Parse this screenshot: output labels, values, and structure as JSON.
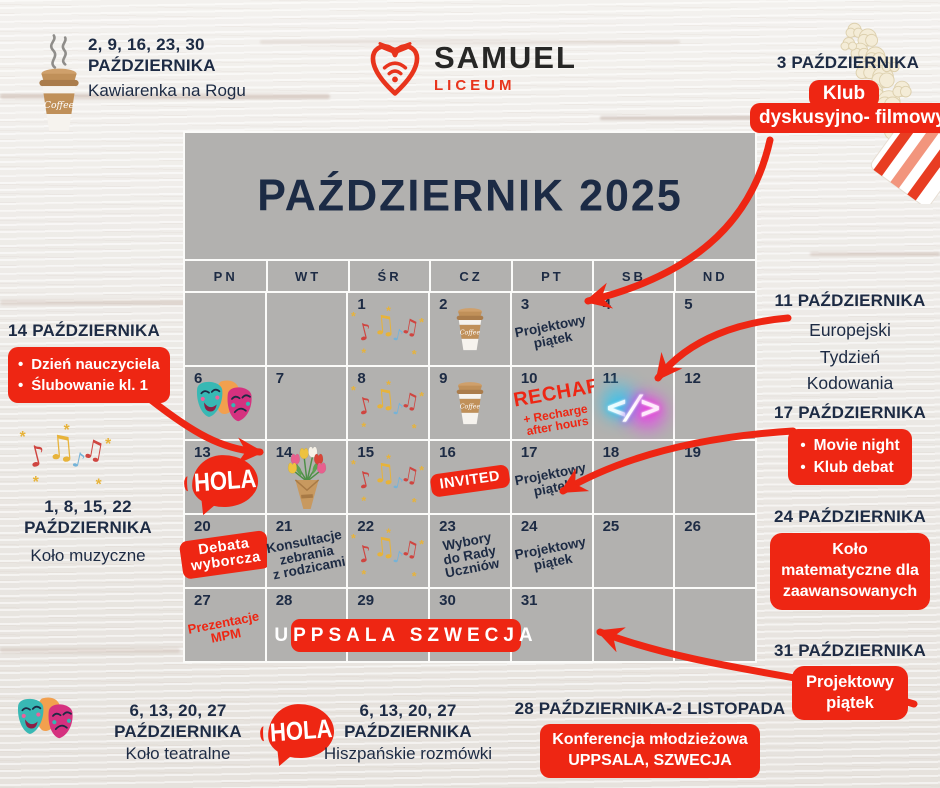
{
  "logo": {
    "name": "SAMUEL",
    "subtitle": "LICEUM"
  },
  "annotations": {
    "coffee": {
      "icon": "coffee-cup-icon",
      "dates": "2, 9, 16, 23, 30",
      "month": "PAŹDZIERNIKA",
      "label": "Kawiarenka na Rogu"
    },
    "film_club": {
      "icon": "popcorn-icon",
      "date": "3 PAŹDZIERNIKA",
      "badge": [
        "Klub",
        "dyskusyjno- filmowy"
      ]
    },
    "teachers_day": {
      "date": "14 PAŹDZIERNIKA",
      "badge": [
        "Dzień nauczyciela",
        "Ślubowanie kl. 1"
      ]
    },
    "music_club": {
      "icon": "music-notes-icon",
      "dates": "1, 8, 15, 22",
      "month": "PAŹDZIERNIKA",
      "label": "Koło muzyczne"
    },
    "coding_week": {
      "date": "11 PAŹDZIERNIKA",
      "lines": [
        "Europejski",
        "Tydzień",
        "Kodowania"
      ]
    },
    "movie_night": {
      "date": "17 PAŹDZIERNIKA",
      "badge": [
        "Movie night",
        "Klub debat"
      ]
    },
    "math_club": {
      "date": "24 PAŹDZIERNIKA",
      "badge": [
        "Koło",
        "matematyczne dla",
        "zaawansowanych"
      ]
    },
    "project_friday_31": {
      "date": "31 PAŹDZIERNIKA",
      "badge": [
        "Projektowy",
        "piątek"
      ]
    },
    "theatre_club": {
      "icon": "theater-masks-icon",
      "dates": "6, 13, 20, 27",
      "month": "PAŹDZIERNIKA",
      "label": "Koło teatralne"
    },
    "spanish_talks": {
      "icon": "hola-speech-bubble-icon",
      "dates": "6, 13, 20, 27",
      "month": "PAŹDZIERNIKA",
      "label": "Hiszpańskie rozmówki"
    },
    "conference": {
      "date": "28 PAŹDZIERNIKA-2 LISTOPADA",
      "badge": [
        "Konferencja młodzieżowa",
        "UPPSALA, SZWECJA"
      ]
    }
  },
  "calendar": {
    "title": "PAŹDZIERNIK 2025",
    "day_headers": [
      "PN",
      "WT",
      "ŚR",
      "CZ",
      "PT",
      "SB",
      "ND"
    ],
    "uppsala_badge": "UPPSALA SZWECJA",
    "cells": [
      {},
      {},
      {
        "day": "1",
        "icon": "music-notes-icon"
      },
      {
        "day": "2",
        "icon": "coffee-cup-icon"
      },
      {
        "day": "3",
        "note": [
          "Projektowy",
          "piątek"
        ],
        "style": "navy"
      },
      {
        "day": "4"
      },
      {
        "day": "5"
      },
      {
        "day": "6",
        "icon": "theater-masks-icon"
      },
      {
        "day": "7"
      },
      {
        "day": "8",
        "icon": "music-notes-icon"
      },
      {
        "day": "9",
        "icon": "coffee-cup-icon"
      },
      {
        "day": "10",
        "note": [
          "RECHARGE"
        ],
        "note2": [
          "+ Recharge",
          "after hours"
        ],
        "style": "red-big"
      },
      {
        "day": "11",
        "icon": "code-neon-icon"
      },
      {
        "day": "12"
      },
      {
        "day": "13",
        "icon": "hola-speech-bubble-icon"
      },
      {
        "day": "14",
        "icon": "tulip-bouquet-icon"
      },
      {
        "day": "15",
        "icon": "music-notes-icon"
      },
      {
        "day": "16",
        "badge": [
          "INVITED"
        ]
      },
      {
        "day": "17",
        "note": [
          "Projektowy",
          "piątek"
        ],
        "style": "navy"
      },
      {
        "day": "18"
      },
      {
        "day": "19"
      },
      {
        "day": "20",
        "badge": [
          "Debata",
          "wyborcza"
        ]
      },
      {
        "day": "21",
        "note": [
          "Konsultacje",
          "zebrania",
          "z rodzicami"
        ],
        "style": "navy"
      },
      {
        "day": "22",
        "icon": "music-notes-icon"
      },
      {
        "day": "23",
        "note": [
          "Wybory",
          "do Rady",
          "Uczniów"
        ],
        "style": "navy"
      },
      {
        "day": "24",
        "note": [
          "Projektowy",
          "piątek"
        ],
        "style": "navy"
      },
      {
        "day": "25"
      },
      {
        "day": "26"
      },
      {
        "day": "27",
        "note": [
          "Prezentacje",
          "MPM"
        ],
        "style": "red"
      },
      {
        "day": "28"
      },
      {
        "day": "29"
      },
      {
        "day": "30"
      },
      {
        "day": "31"
      },
      {},
      {}
    ]
  },
  "icons": {
    "hola_text": "HOLA",
    "code_symbol": "</>",
    "coffee_cup_label": "Coffee",
    "names": [
      "coffee-cup-icon",
      "music-notes-icon",
      "theater-masks-icon",
      "hola-speech-bubble-icon",
      "tulip-bouquet-icon",
      "code-neon-icon",
      "popcorn-icon",
      "samuel-heart-logo-icon"
    ]
  },
  "colors": {
    "accent_red": "#ee2613",
    "navy": "#1d2b44",
    "calendar_gray": "#b2b1af"
  }
}
